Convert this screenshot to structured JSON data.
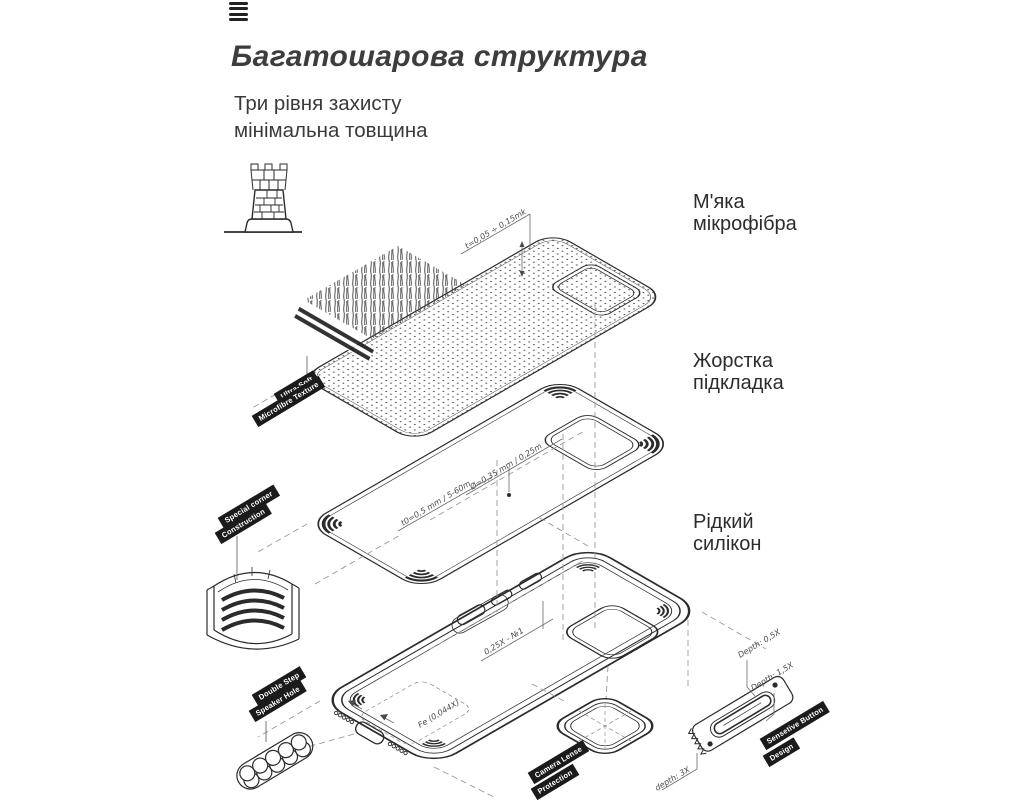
{
  "header": {
    "title": "Багатошарова структура",
    "subtitle_line1": "Три рівня захисту",
    "subtitle_line2": "мінімальна товщина"
  },
  "layer_labels": [
    {
      "line1": "М'яка",
      "line2": "мікрофібра"
    },
    {
      "line1": "Жорстка",
      "line2": "підкладка"
    },
    {
      "line1": "Рідкий",
      "line2": "силікон"
    }
  ],
  "ribbons": {
    "microfiber": [
      "Ultra-Soft",
      "Microfibre Texture"
    ],
    "corner": [
      "Special corner",
      "Construction"
    ],
    "speaker": [
      "Double Step",
      "Speaker Hole"
    ],
    "camera": [
      "Camera Lense",
      "Protection"
    ],
    "button": [
      "Sensetive Button",
      "Design"
    ]
  },
  "annotations": {
    "microfiber_thickness": "t=0,05 ÷ 0,15mk",
    "lining_thickness_a": "Ø=0,35 mm / 0,25m",
    "lining_thickness_b": "t0=0,5 mm / 5-60m",
    "button_offset": "0,25X - №1",
    "floor_marking": "Fe (0,044X)",
    "button_depth_a": "Depth: 0,5X",
    "button_depth_b": "Depth: 1,5X",
    "button_depth_c": "depth: 3X"
  },
  "icons": {
    "menu": "hamburger-menu-icon",
    "tower": "castle-tower-icon"
  },
  "colors": {
    "ink": "#2b2b2b",
    "dash": "#9a9a9a",
    "ribbon_bg": "#1b1b1b",
    "ribbon_text": "#ffffff",
    "title": "#3d3d3d"
  }
}
